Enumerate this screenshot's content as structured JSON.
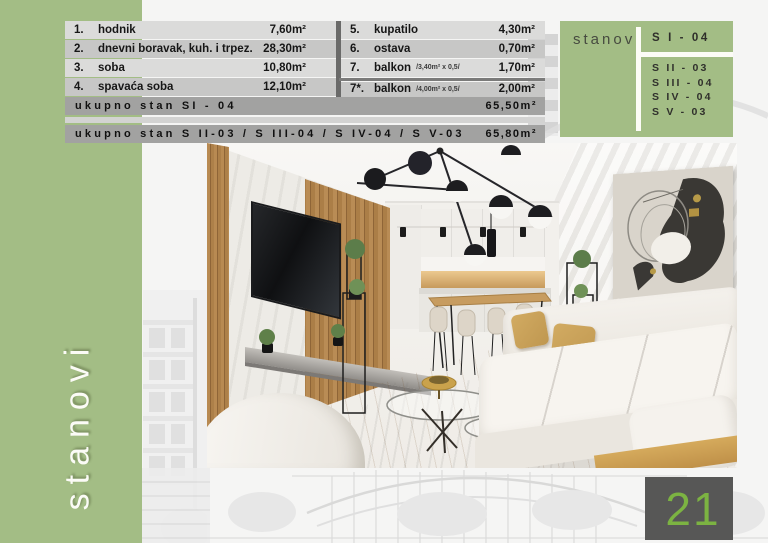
{
  "page_number": "21",
  "sidebar": {
    "vertical_label": "stanovi"
  },
  "room_table": {
    "left_rows": [
      {
        "num": "1.",
        "label": "hodnik",
        "value": "7,60m²"
      },
      {
        "num": "2.",
        "label": "dnevni boravak, kuh.  i trpez.",
        "value": "28,30m²"
      },
      {
        "num": "3.",
        "label": "soba",
        "value": "10,80m²"
      },
      {
        "num": "4.",
        "label": "spavaća soba",
        "value": "12,10m²"
      }
    ],
    "right_rows": [
      {
        "num": "5.",
        "label": "kupatilo",
        "note": "",
        "value": "4,30m²"
      },
      {
        "num": "6.",
        "label": "ostava",
        "note": "",
        "value": "0,70m²"
      },
      {
        "num": "7.",
        "label": "balkon",
        "note": "/3,40m² x 0,5/",
        "value": "1,70m²"
      },
      {
        "num": "7*.",
        "label": "balkon",
        "note": "/4,00m² x 0,5/",
        "value": "2,00m²"
      }
    ]
  },
  "totals": [
    {
      "label": "ukupno stan SI - 04",
      "value": "65,50m²"
    },
    {
      "label": "ukupno stan S II-03 / S III-04 / S IV-04 / S V-03",
      "value": "65,80m²"
    }
  ],
  "apartments_panel": {
    "title": "stanovi",
    "primary": "S I - 04",
    "items": [
      "S II - 03",
      "S III - 04",
      "S IV - 04",
      "S V - 03"
    ]
  },
  "colors": {
    "green": "#a3bd85",
    "accent_green": "#7cb342",
    "bar_gray": "#a2a2a1",
    "row_light": "#dbdbda",
    "row_dark": "#c7c7c6",
    "divider_gray": "#6a6a69",
    "page_box_gray": "#575756"
  }
}
